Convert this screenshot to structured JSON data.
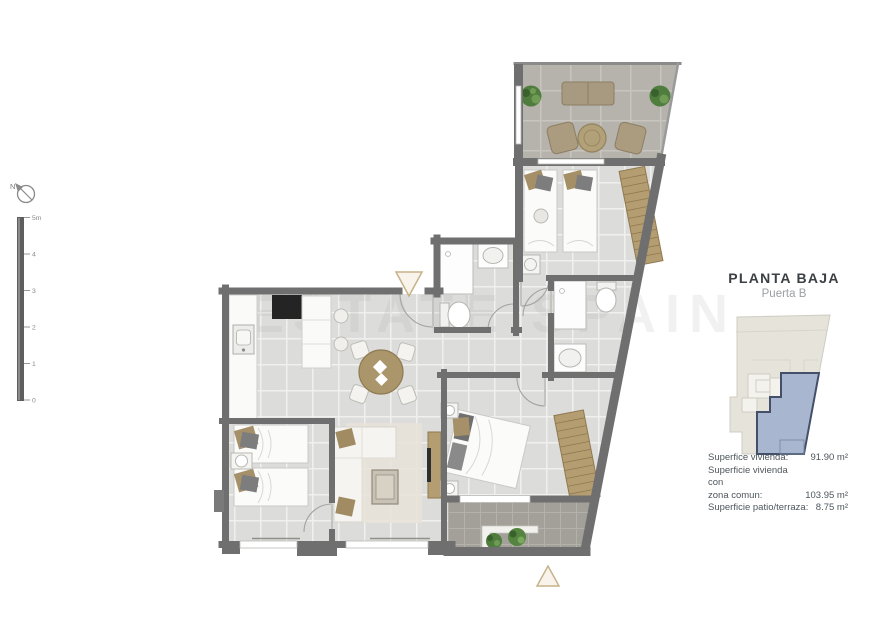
{
  "compass": {
    "label": "N"
  },
  "scale_bar": {
    "labels": [
      "5m",
      "4",
      "3",
      "2",
      "1",
      "0"
    ]
  },
  "watermark": {
    "text": "ESTATE SPAIN"
  },
  "panel": {
    "title": "PLANTA BAJA",
    "subtitle": "Puerta B",
    "measurements": [
      {
        "label": "Superfice vivienda:",
        "value": "91.90 m²"
      },
      {
        "label": "Superficie vivienda con\nzona comun:",
        "value": "103.95 m²"
      },
      {
        "label": "Superficie patio/terraza:",
        "value": "8.75 m²"
      }
    ]
  },
  "colors": {
    "wall": "#6f6f6f",
    "floor": "#dcdcda",
    "terrace_floor": "#b6b2ac",
    "patio_floor": "#a3a099",
    "wood": "#b59d72",
    "plant_green": "#4e7d3e",
    "unit_fill": "#a9b6cf",
    "unit_stroke": "#44506a",
    "building_fill": "#e6e3db",
    "marker_accent": "#c7b28a"
  }
}
